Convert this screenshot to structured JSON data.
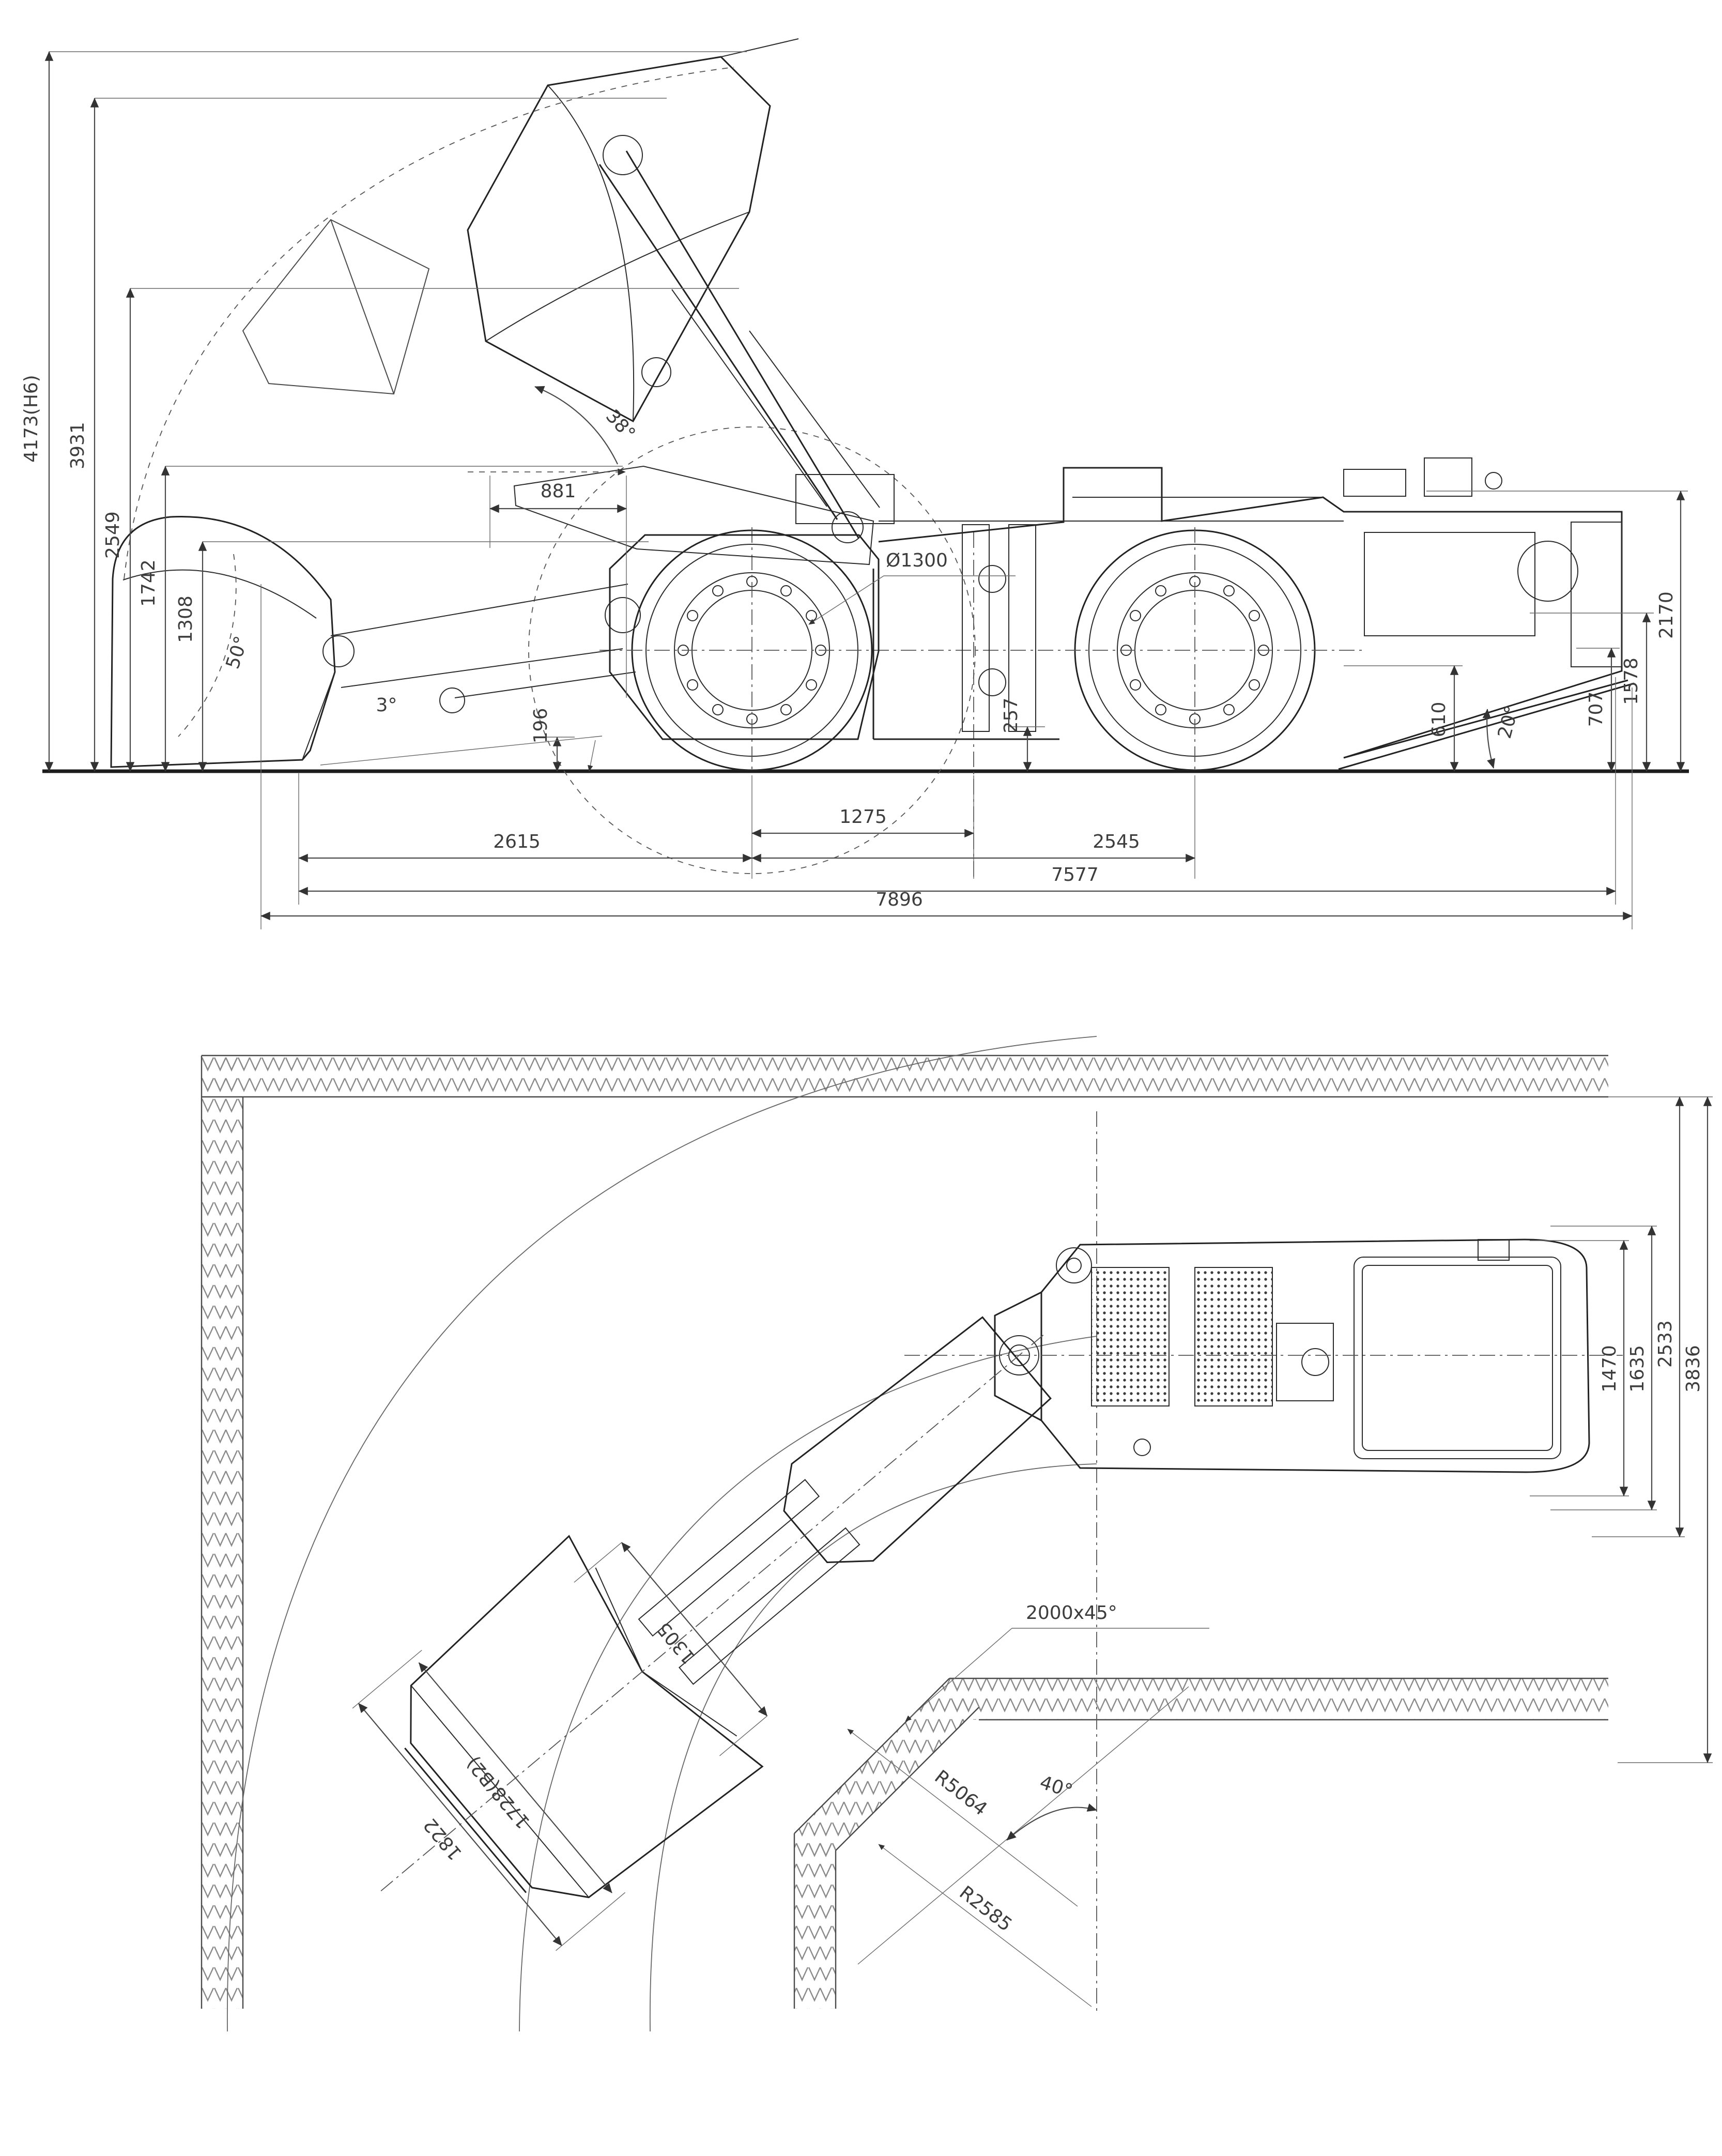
{
  "meta": {
    "drawing_type": "LHD underground loader outline dimensional drawing",
    "colors": {
      "background": "#ffffff",
      "line": "#222222",
      "dimension": "#4a4a4a",
      "hatch": "#8a8a8a"
    }
  },
  "side_view": {
    "dims": {
      "h_max_lift": "4173(H6)",
      "h_dump": "3931",
      "h_boom": "2549",
      "h_pin": "1742",
      "h_axle_line": "1308",
      "d_overhang": "881",
      "tire_dia": "Ø1300",
      "dump_angle": "38°",
      "rollback_angle": "50°",
      "blade_angle": "3°",
      "clearance_front": "196",
      "clearance_mid": "257",
      "axle_to_hinge": "1275",
      "front_length": "2615",
      "wheelbase": "2545",
      "length_body": "7577",
      "length_total": "7896",
      "h_machine": "2170",
      "h_rear": "1578",
      "h_deck": "707",
      "h_ramp": "610",
      "departure_angle": "20°"
    }
  },
  "plan_view": {
    "dims": {
      "w_inner": "1470",
      "w_body": "1635",
      "w_swing": "2533",
      "w_tunnel": "3836",
      "corner_chamfer": "2000x45°",
      "bucket_inner": "1305",
      "bucket_width": "1728(B2)",
      "bucket_outer": "1822",
      "turn_radius_outer": "R5064",
      "turn_radius_inner": "R2585",
      "articulation_angle": "40°"
    }
  }
}
